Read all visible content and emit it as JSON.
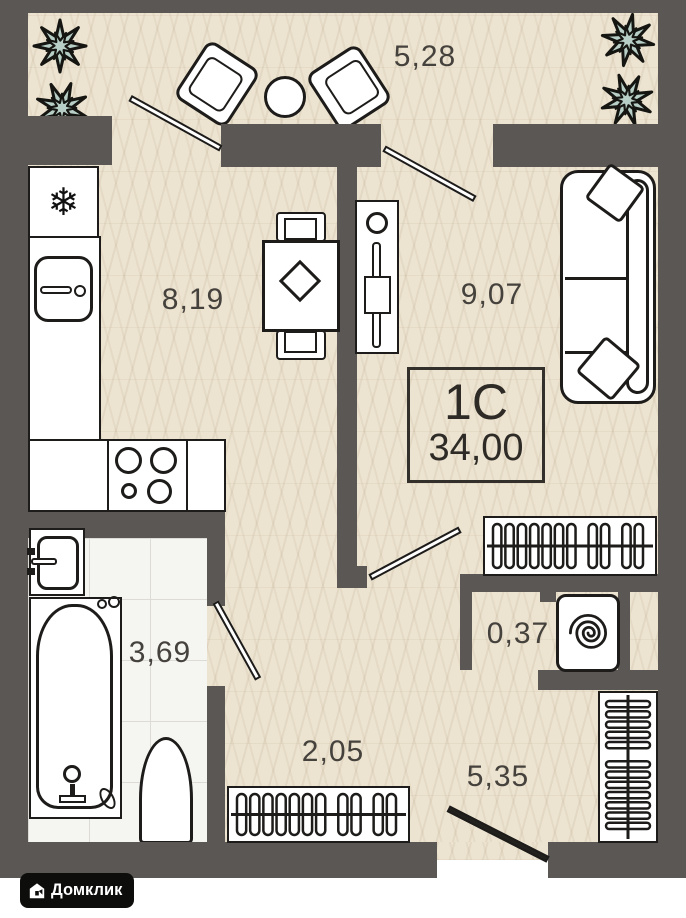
{
  "unit": {
    "type_label": "1С",
    "total_area": "34,00"
  },
  "rooms": {
    "balcony": {
      "area": "5,28"
    },
    "kitchen": {
      "area": "8,19"
    },
    "living_room": {
      "area": "9,07"
    },
    "bathroom": {
      "area": "3,69"
    },
    "niche": {
      "area": "0,37"
    },
    "hallway": {
      "area": "2,05"
    },
    "corridor": {
      "area": "5,35"
    }
  },
  "icons": {
    "fridge_snowflake": "❄"
  },
  "branding": {
    "logo_text": "Домклик"
  },
  "colors": {
    "wall": "#5b5754",
    "floor": "#ece3d0",
    "tile": "#f5f5f2",
    "plant": "#b7cfc6",
    "line": "#1d1c1a",
    "logo_bg": "#0d0d0c"
  }
}
